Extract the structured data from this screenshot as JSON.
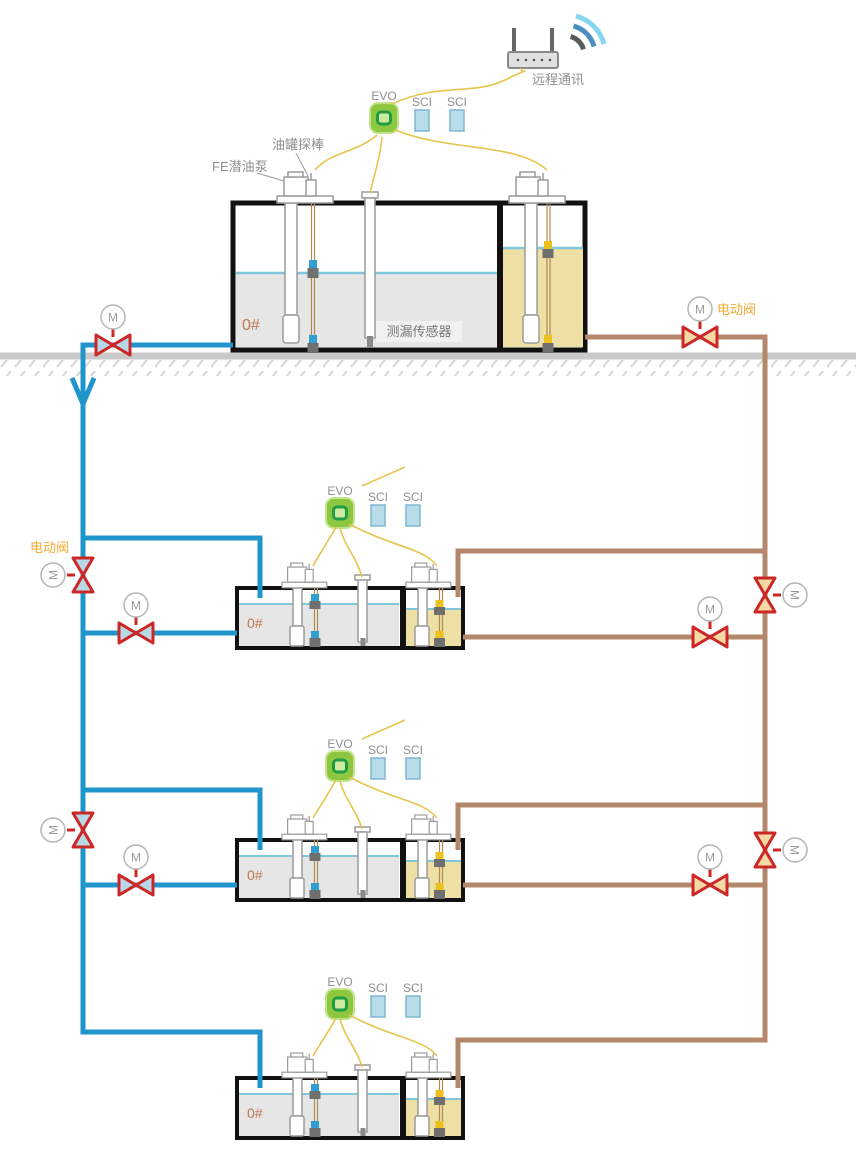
{
  "diagram_type": "fuel-station-tank-monitoring-schematic",
  "labels": {
    "remote_comm": "远程通讯",
    "evo": "EVO",
    "sci": "SCI",
    "tank_probe": "油罐探棒",
    "fe_pump": "FE潜油泵",
    "leak_sensor": "测漏传感器",
    "electric_valve": "电动阀",
    "fuel_grade": "0#",
    "motor": "M"
  },
  "colors": {
    "supply_pipe_blue": "#2095cc",
    "return_pipe_brown": "#b5876a",
    "valve_red": "#cc2727",
    "valve_fill_blue": "#b8d8e8",
    "valve_fill_tan": "#f2d9a6",
    "wire_yellow": "#e6c44d",
    "evo_green": "#8dc63f",
    "sci_blue": "#b8dcea",
    "diesel_liquid_gray": "#e6e6e6",
    "gasoline_liquid_tan": "#eedfa5",
    "water_line_blue": "#7fc8dc",
    "label_gray": "#8f8f8f",
    "electric_valve_label_orange": "#f0a830",
    "grade_label": "#c07850"
  },
  "counts": {
    "tanks": 4,
    "evo_consoles": 4,
    "sci_modules": 8,
    "motor_valves": 10
  }
}
